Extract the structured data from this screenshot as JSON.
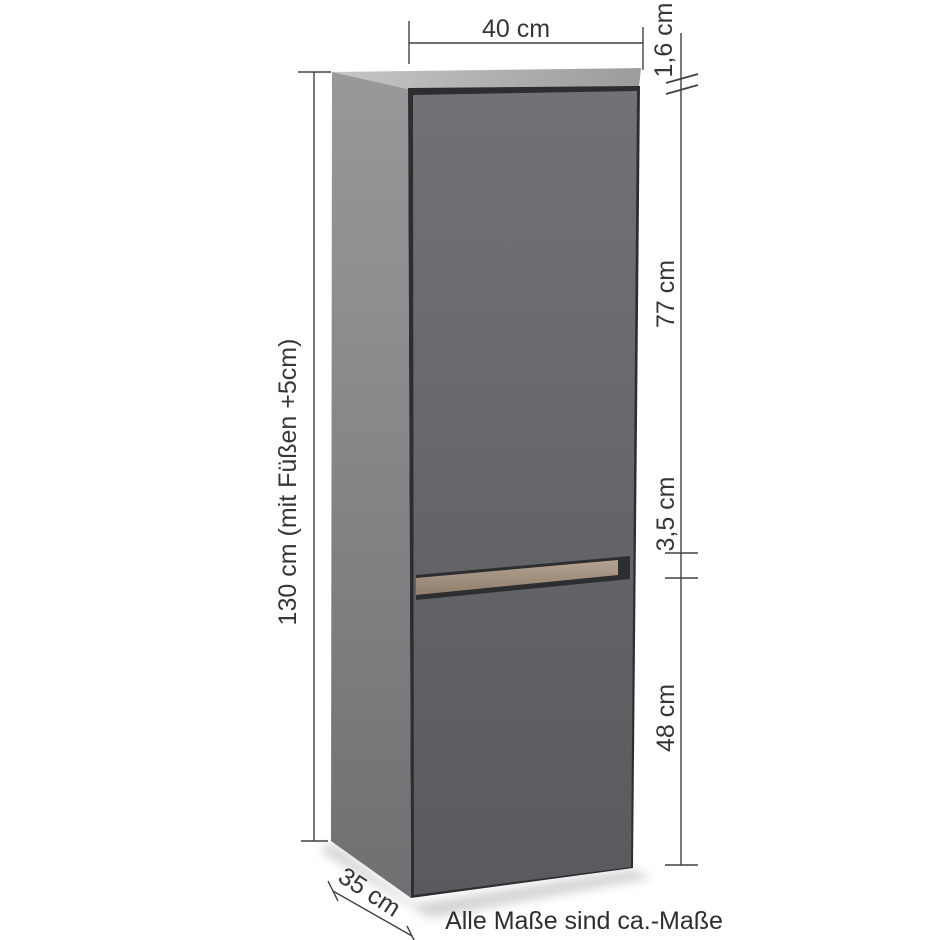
{
  "labels": {
    "width": "40 cm",
    "top_panel_thickness": "1,6 cm",
    "upper_door_height": "77 cm",
    "handle_recess_height": "3,5 cm",
    "lower_door_height": "48 cm",
    "total_height": "130 cm (mit Füßen +5cm)",
    "depth": "35 cm"
  },
  "note": "Alle Maße sind ca.-Maße",
  "colors": {
    "background": "#ffffff",
    "line": "#3f4143",
    "text": "#363636",
    "top_face_light": "#c4c6c8",
    "top_face_dark": "#9a9c9e",
    "side_panel_light": "#97999b",
    "side_panel_dark": "#6e7072",
    "door_light": "#707275",
    "door_dark": "#585a5d",
    "gap_dark": "#2c2e30",
    "wood_light": "#b5a492",
    "wood_dark": "#8d7b69",
    "shadow": "#a0a0a0"
  }
}
